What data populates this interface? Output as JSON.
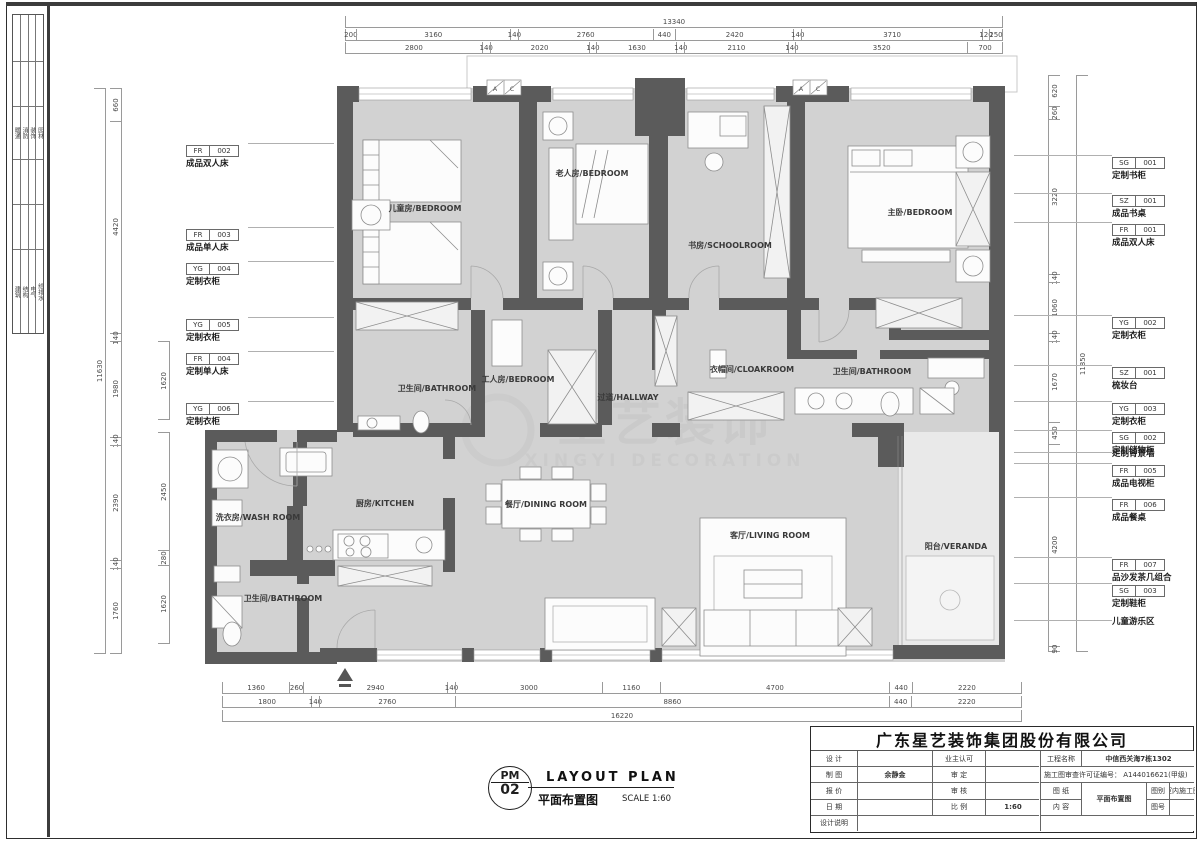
{
  "sheet": {
    "company": "广东星艺装饰集团股份有限公司",
    "disciplines_row1": [
      "暖通",
      "消防",
      "装饰",
      "园林"
    ],
    "disciplines_row2": [
      "建筑",
      "结构",
      "电气",
      "给排水"
    ],
    "stamp": {
      "code_top": "PM",
      "code_bottom": "02",
      "title_en": "LAYOUT  PLAN",
      "title_cn": "平面布置图",
      "scale_note": "SCALE 1:60"
    },
    "title_block": {
      "design_label": "设 计",
      "design_value": "",
      "owner_label": "业主认可",
      "owner_value": "",
      "draft_label": "制 图",
      "draft_value": "余静金",
      "approve_label": "审 定",
      "approve_value": "",
      "quote_label": "报 价",
      "quote_value": "",
      "review_label": "审 核",
      "review_value": "",
      "date_label": "日 期",
      "date_value": "",
      "scale_label": "比 例",
      "scale_value": "1:60",
      "notes_label": "设计说明",
      "project_label": "工程名称",
      "project_value": "中信西关海7栋1302",
      "permit_text": "施工图审查许可证编号： A144016621(甲级)",
      "sheet_label_1": "图 纸",
      "sheet_label_2": "内 容",
      "sheet_content": "平面布置图",
      "category_label": "图别",
      "category_value": "室内施工图",
      "number_label": "图号",
      "number_value": ""
    }
  },
  "watermark": {
    "cn": "星艺装饰",
    "en": "XINGYI DECORATION"
  },
  "plan": {
    "ac_a": "A",
    "ac_c": "C"
  },
  "rooms": {
    "children": "儿童房/BEDROOM",
    "elder": "老人房/BEDROOM",
    "study": "书房/SCHOOLROOM",
    "master": "主卧/BEDROOM",
    "bath1": "卫生间/BATHROOM",
    "worker": "工人房/BEDROOM",
    "hallway": "过道/HALLWAY",
    "cloak": "衣帽间/CLOAKROOM",
    "bath2": "卫生间/BATHROOM",
    "wash": "洗衣房/WASH ROOM",
    "kitchen": "厨房/KITCHEN",
    "dining": "餐厅/DINING ROOM",
    "bath3": "卫生间/BATHROOM",
    "living": "客厅/LIVING ROOM",
    "veranda": "阳台/VERANDA"
  },
  "dimensions": {
    "top_total": [
      "13340"
    ],
    "top_row1": [
      "200",
      "3160",
      "140",
      "2760",
      "440",
      "2420",
      "140",
      "3710",
      "120",
      "250"
    ],
    "top_row2": [
      "2800",
      "140",
      "2020",
      "140",
      "1630",
      "140",
      "2110",
      "140",
      "3520",
      "700"
    ],
    "bottom_row1": [
      "1360",
      "260",
      "2940",
      "140",
      "3000",
      "1160",
      "4700",
      "440",
      "2220"
    ],
    "bottom_row2": [
      "1800",
      "140",
      "2760",
      "8860",
      "440",
      "2220"
    ],
    "bottom_total": [
      "16220"
    ],
    "left_total": [
      "11630"
    ],
    "left_inner": [
      "660",
      "4420",
      "140",
      "1980",
      "140",
      "2390",
      "140",
      "1760"
    ],
    "left_partial_a": [
      "1620"
    ],
    "left_partial_b": [
      "2450",
      "280",
      "1620"
    ],
    "right_inner": [
      "620",
      "260",
      "3220",
      "140",
      "1060",
      "140",
      "1670",
      "450",
      "4200",
      "90"
    ],
    "right_total": [
      "11850"
    ]
  },
  "callouts": {
    "left": [
      {
        "code": "FR",
        "num": "002",
        "label": "成品双人床"
      },
      {
        "code": "FR",
        "num": "003",
        "label": "成品单人床"
      },
      {
        "code": "YG",
        "num": "004",
        "label": "定制衣柜"
      },
      {
        "code": "YG",
        "num": "005",
        "label": "定制衣柜"
      },
      {
        "code": "FR",
        "num": "004",
        "label": "定制单人床"
      },
      {
        "code": "YG",
        "num": "006",
        "label": "定制衣柜"
      }
    ],
    "right": [
      {
        "code": "SG",
        "num": "001",
        "label": "定制书柜"
      },
      {
        "code": "SZ",
        "num": "001",
        "label": "成品书桌"
      },
      {
        "code": "FR",
        "num": "001",
        "label": "成品双人床"
      },
      {
        "code": "YG",
        "num": "002",
        "label": "定制衣柜"
      },
      {
        "code": "SZ",
        "num": "001",
        "label": "梳妆台"
      },
      {
        "code": "YG",
        "num": "003",
        "label": "定制衣柜"
      },
      {
        "code": "SG",
        "num": "002",
        "label": "定制储物柜"
      },
      {
        "code": "",
        "num": "",
        "label": "定制背景墙"
      },
      {
        "code": "FR",
        "num": "005",
        "label": "成品电视柜"
      },
      {
        "code": "FR",
        "num": "006",
        "label": "成品餐桌"
      },
      {
        "code": "FR",
        "num": "007",
        "label": "品沙发茶几组合"
      },
      {
        "code": "SG",
        "num": "003",
        "label": "定制鞋柜"
      },
      {
        "code": "",
        "num": "",
        "label": "儿童游乐区"
      }
    ]
  }
}
